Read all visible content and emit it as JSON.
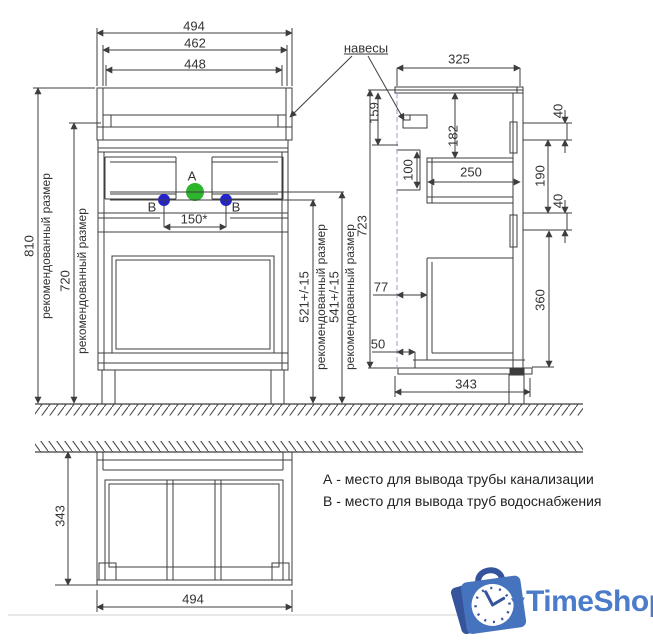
{
  "front": {
    "w1": "494",
    "w2": "462",
    "w3": "448",
    "h_total": "810",
    "h_total_note": "рекомендованный размер",
    "h_body": "720",
    "h_body_note": "рекомендованный размер",
    "spacing": "150*",
    "point_a": "А",
    "point_b": "В",
    "water_h": "521+/-15",
    "water_h_note": "рекомендованный размер",
    "drain_h": "541+/-15",
    "drain_h_note": "рекомендованный размер",
    "side_h": "723"
  },
  "side": {
    "callout": "навесы",
    "depth_top": "325",
    "d159": "159",
    "d182": "182",
    "d100": "100",
    "d250": "250",
    "d40a": "40",
    "d190": "190",
    "d40b": "40",
    "d77": "77",
    "d50": "50",
    "d360": "360",
    "depth_bottom": "343"
  },
  "top": {
    "depth": "343",
    "width": "494"
  },
  "legend": {
    "line_a": "А - место для вывода трубы канализации",
    "line_b": "В - место для вывода труб водоснабжения"
  },
  "logo": {
    "name": "TimeShop"
  },
  "colors": {
    "line_color": "#3d3d3d",
    "point_a": "#2db52d",
    "point_b": "#2222cf",
    "dash_color": "#9898cc",
    "logo_mid": "#4673bd",
    "logo_dark": "#35549b",
    "logo_text": "#4a7cc9"
  }
}
